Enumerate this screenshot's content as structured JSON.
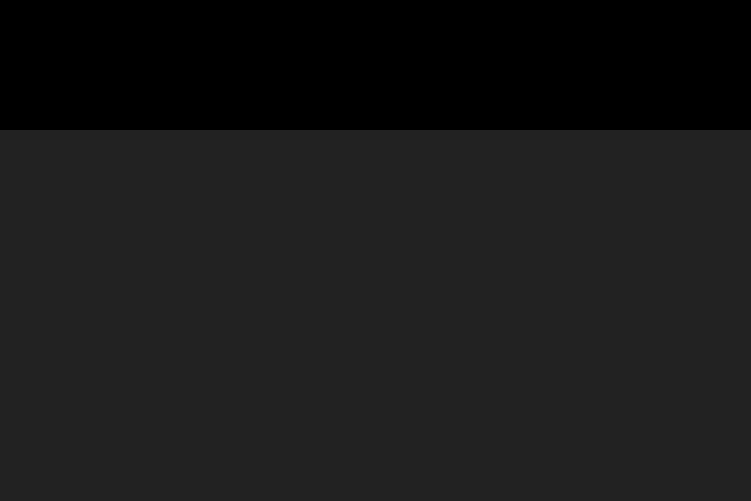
{
  "meta": {
    "type": "3d-architectural-aerial-rendering",
    "width_px": 751,
    "height_px": 501
  },
  "scene": {
    "description": "Aerial 3D rendering of a master-planned desert community: rows of flat-roofed beige villas along a tree-lined street grid, a long retail strip with a gray roof, dark colonnade, palm trees and orange patio umbrellas, a red-brown parking lot with parked cars, a wide arterial road with double yellow dashed lane lines and crosswalks, windbreak poplar rows, farm fields, and hazy mountains with a snow-capped peak under a pale blue sky.",
    "elements": [
      "sky",
      "mountain-range",
      "snow-capped-peak",
      "farm-fields",
      "windbreak-poplar-rows",
      "open-pasture",
      "residential-villas",
      "neighborhood-streets",
      "left-boulevard",
      "retail-strip-building",
      "entry-tower",
      "patio-umbrellas",
      "palm-trees",
      "monument-sign",
      "red-retail-signs",
      "parking-lot",
      "parking-stripes",
      "parked-cars",
      "access-apron",
      "landscaped-median",
      "roundabout",
      "arterial-road",
      "yellow-lane-dashes",
      "crosswalks",
      "moving-cars",
      "sidewalk",
      "foreground-lawn",
      "foreground-poplar-trees",
      "tree-shadows"
    ],
    "counts": {
      "patio_umbrellas": 6,
      "foreground_poplars": 11,
      "windbreak_rows": 2,
      "palm_trees": 18,
      "parked_cars_main_lot": 27,
      "parked_cars_upper_row": 6,
      "moving_cars": 7,
      "crosswalks": 3,
      "residential_house_rows": 7
    }
  },
  "palette": {
    "sky_top": "#c7d9e1",
    "sky_horizon": "#e9efee",
    "mountain_far": "#c9c2b0",
    "mountain_near": "#a9a795",
    "snow": "#f6f6f1",
    "haze": "#ffffff",
    "farm_base": "#b5bf9c",
    "field_light": "#cdd3b4",
    "field_green": "#9db987",
    "field_tan": "#d6d1b6",
    "field_green2": "#92af7d",
    "field_brown": "#8f7250",
    "open_field": "#8fae6a",
    "fence": "#eeeee4",
    "poplar_dark": "#2f5226",
    "poplar_mid": "#3e6130",
    "poplar_light": "#5a7d36",
    "res_green": "#7e9455",
    "res_green2": "#88a05f",
    "verge_green": "#6f854b",
    "street_tan": "#b1ada0",
    "street_gray": "#7a7e81",
    "boulevard": "#7e8184",
    "sidewalk": "#cfccc4",
    "house_wall": "#dfd6bd",
    "house_wall2": "#d6cbae",
    "house_roof": "#e8e0ca",
    "house_shade": "#8d8471",
    "house_dark": "#4a4038",
    "tree_dark": "#35552a",
    "tree_mid": "#467031",
    "tree_light": "#578338",
    "strip_roof": "#c6c5bf",
    "strip_fascia": "#f0efe9",
    "strip_face": "#332e28",
    "strip_column": "#d8d0c0",
    "plaza": "#d6cfc0",
    "patio": "#ded7c8",
    "umbrella": "#d2662a",
    "umbrella_dark": "#a8481f",
    "palm": "#2c5024",
    "palm_trunk": "#6b5a42",
    "upper_roof": "#b5b0a6",
    "monument": "#8a3b2c",
    "sign_red": "#a03428",
    "parking": "#6b4c44",
    "parking_light": "#7a574d",
    "stripe": "#eceae3",
    "pole": "#3c3c3c",
    "road": "#8b8c88",
    "road_light": "#9a988f",
    "road_edge": "#e8e6df",
    "lane_yellow": "#c9a23e",
    "lane_white": "#d8d6cf",
    "car_white": "#f2f1ee",
    "car_dark": "#2e3134",
    "car_silver": "#c3c6c8",
    "car_glass": "#23262a",
    "lawn": "#76833f",
    "lawn2": "#8a9751",
    "lawn_streak": "#98a35c",
    "shadow": "#3f4f2a",
    "trunk": "#9b8a68",
    "planter_base": "#cfc8b2",
    "shrub": "#5d7a3a"
  },
  "layout": {
    "seed": 987654321,
    "mountain_far_ridge": [
      [
        0,
        86
      ],
      [
        30,
        78
      ],
      [
        70,
        72
      ],
      [
        100,
        78
      ],
      [
        130,
        86
      ],
      [
        160,
        82
      ],
      [
        200,
        90
      ],
      [
        240,
        86
      ],
      [
        280,
        94
      ],
      [
        320,
        90
      ],
      [
        360,
        95
      ],
      [
        395,
        88
      ],
      [
        430,
        80
      ],
      [
        465,
        72
      ],
      [
        495,
        66
      ],
      [
        520,
        58
      ],
      [
        540,
        50
      ],
      [
        552,
        56
      ],
      [
        565,
        64
      ],
      [
        585,
        60
      ],
      [
        605,
        55
      ],
      [
        625,
        64
      ],
      [
        645,
        60
      ],
      [
        665,
        68
      ],
      [
        685,
        62
      ],
      [
        705,
        72
      ],
      [
        725,
        66
      ],
      [
        751,
        72
      ]
    ],
    "mountain_near_ridge": [
      [
        370,
        112
      ],
      [
        400,
        96
      ],
      [
        430,
        88
      ],
      [
        455,
        92
      ],
      [
        480,
        84
      ],
      [
        505,
        88
      ],
      [
        525,
        76
      ],
      [
        545,
        84
      ],
      [
        565,
        78
      ],
      [
        590,
        84
      ],
      [
        610,
        76
      ],
      [
        635,
        86
      ],
      [
        655,
        80
      ],
      [
        680,
        90
      ],
      [
        700,
        84
      ],
      [
        725,
        94
      ],
      [
        751,
        86
      ]
    ],
    "snow_peak": [
      [
        528,
        62
      ],
      [
        540,
        50
      ],
      [
        552,
        58
      ],
      [
        545,
        66
      ],
      [
        534,
        68
      ]
    ],
    "snow_patches": [
      [
        470,
        72,
        14,
        3,
        0.5
      ],
      [
        620,
        60,
        18,
        3.5,
        0.5
      ],
      [
        700,
        70,
        16,
        3,
        0.45
      ],
      [
        160,
        84,
        20,
        3,
        0.25
      ]
    ],
    "field_strips": [
      {
        "y": 110,
        "h": 7,
        "c": "field_light"
      },
      {
        "y": 117,
        "h": 7,
        "c": "field_green"
      },
      {
        "y": 124,
        "h": 6,
        "c": "field_tan"
      },
      {
        "y": 130,
        "h": 7,
        "c": "field_green2"
      },
      {
        "y": 137,
        "h": 7,
        "c": "field_brown"
      },
      {
        "y": 144,
        "h": 7,
        "c": "field_green"
      },
      {
        "y": 151,
        "h": 6,
        "c": "field_tan"
      },
      {
        "y": 157,
        "h": 6,
        "c": "field_green2"
      },
      {
        "y": 163,
        "h": 7,
        "c": "field_light"
      }
    ],
    "open_field_poly": [
      [
        555,
        108
      ],
      [
        751,
        92
      ],
      [
        751,
        172
      ],
      [
        575,
        168
      ]
    ],
    "fence_ys": [
      112,
      124,
      136,
      150
    ],
    "distant_blob_count": 34,
    "poplar_far": {
      "x0": 4,
      "x1": 748,
      "gap": 13.5,
      "bottom": 131,
      "h": 19
    },
    "poplar_near": {
      "x0": 2,
      "x1": 748,
      "gap": 17,
      "bottom0": 140,
      "bslope": 0.05,
      "h0": 24,
      "hslope": 0.045
    },
    "res_zone": [
      [
        0,
        138
      ],
      [
        230,
        142
      ],
      [
        470,
        152
      ],
      [
        751,
        166
      ],
      [
        751,
        240
      ],
      [
        0,
        420
      ]
    ],
    "res_streets": [
      {
        "x0": 80,
        "y0": 172,
        "slope": -0.055,
        "len": 620,
        "w": 5
      },
      {
        "x0": 0,
        "y0": 196,
        "slope": -0.062,
        "len": 720,
        "w": 6
      },
      {
        "x0": 0,
        "y0": 222,
        "slope": -0.075,
        "len": 720,
        "w": 7
      },
      {
        "x0": 0,
        "y0": 250,
        "slope": -0.085,
        "len": 660,
        "w": 7
      },
      {
        "x0": 0,
        "y0": 280,
        "slope": -0.095,
        "len": 480,
        "w": 8
      },
      {
        "x0": 0,
        "y0": 312,
        "slope": -0.105,
        "len": 300,
        "w": 8
      }
    ],
    "cross_streets": [
      {
        "x0": 208,
        "y0": 150,
        "len": 150
      },
      {
        "x0": 300,
        "y0": 148,
        "len": 150
      },
      {
        "x0": 392,
        "y0": 148,
        "len": 130
      },
      {
        "x0": 480,
        "y0": 150,
        "len": 115
      },
      {
        "x0": 565,
        "y0": 154,
        "len": 90
      }
    ],
    "house_rows": [
      {
        "x0": 150,
        "y0": 160,
        "slope": -0.05,
        "len": 470,
        "w": 11,
        "h": 6,
        "gap": 23
      },
      {
        "x0": 60,
        "y0": 183,
        "slope": -0.06,
        "len": 680,
        "w": 13,
        "h": 7,
        "gap": 25
      },
      {
        "x0": 0,
        "y0": 209,
        "slope": -0.068,
        "len": 745,
        "w": 15,
        "h": 8,
        "gap": 27
      },
      {
        "x0": 0,
        "y0": 236,
        "slope": -0.078,
        "len": 730,
        "w": 17,
        "h": 9,
        "gap": 30
      },
      {
        "x0": 0,
        "y0": 264,
        "slope": -0.088,
        "len": 560,
        "w": 19,
        "h": 11,
        "gap": 33
      },
      {
        "x0": 0,
        "y0": 294,
        "slope": -0.1,
        "len": 390,
        "w": 22,
        "h": 12,
        "gap": 37
      },
      {
        "x0": 30,
        "y0": 322,
        "slope": -0.11,
        "len": 180,
        "w": 24,
        "h": 14,
        "gap": 42
      }
    ],
    "res_tree_count": 62,
    "boulevard": {
      "poly": [
        [
          30,
          150
        ],
        [
          52,
          150
        ],
        [
          98,
          448
        ],
        [
          74,
          452
        ]
      ]
    },
    "left_verge": [
      [
        0,
        150
      ],
      [
        30,
        150
      ],
      [
        74,
        452
      ],
      [
        0,
        470
      ]
    ],
    "diag_streets": [
      {
        "y0": 210,
        "len": 280
      },
      {
        "y0": 254,
        "len": 270
      },
      {
        "y0": 298,
        "len": 250
      },
      {
        "y0": 344,
        "len": 200
      },
      {
        "y0": 390,
        "len": 120
      }
    ],
    "strip": {
      "roofA": [
        162,
        290
      ],
      "roofB": [
        751,
        198
      ],
      "depth": 22,
      "colonnade": 13,
      "plaza": 9
    },
    "anchor_box": [
      [
        196,
        248
      ],
      [
        300,
        232
      ],
      [
        306,
        252
      ],
      [
        202,
        268
      ]
    ],
    "tower": {
      "x": 194,
      "y": 256,
      "w": 14,
      "h": 36
    },
    "upper_retail": [
      [
        560,
        212
      ],
      [
        751,
        182
      ],
      [
        751,
        192
      ],
      [
        563,
        222
      ]
    ],
    "patio_poly": [
      [
        148,
        298
      ],
      [
        238,
        282
      ],
      [
        248,
        318
      ],
      [
        158,
        334
      ]
    ],
    "umbrellas": [
      {
        "x": 172,
        "y": 303
      },
      {
        "x": 184,
        "y": 306
      },
      {
        "x": 194,
        "y": 302
      },
      {
        "x": 200,
        "y": 314
      },
      {
        "x": 188,
        "y": 317
      },
      {
        "x": 209,
        "y": 310
      }
    ],
    "palm_line": {
      "a": [
        180,
        320
      ],
      "b": [
        740,
        232
      ],
      "gap": 32
    },
    "monument": {
      "x": 676,
      "y": 214,
      "w": 7,
      "h": 22
    },
    "red_signs": [
      [
        737,
        201,
        12,
        6
      ],
      [
        738,
        209,
        12,
        5
      ]
    ],
    "parking_poly": [
      [
        172,
        334
      ],
      [
        751,
        242
      ],
      [
        751,
        248
      ],
      [
        172,
        367
      ]
    ],
    "park_rowA": {
      "a": [
        312,
        316
      ],
      "b": [
        746,
        250
      ],
      "n": 50,
      "car_idx": [
        3,
        4,
        7,
        11,
        14,
        15,
        19,
        24,
        28,
        33,
        39,
        45,
        48
      ]
    },
    "park_rowB": {
      "a": [
        330,
        342
      ],
      "b": [
        751,
        278
      ],
      "n": 48,
      "car_idx": [
        2,
        5,
        6,
        9,
        13,
        17,
        18,
        23,
        29,
        34,
        40,
        44,
        46
      ]
    },
    "upper_cars": {
      "a": [
        598,
        206
      ],
      "b": [
        740,
        184
      ],
      "n": 6
    },
    "car_colors": [
      "car_white",
      "car_dark",
      "car_silver",
      "car_white",
      "car_silver",
      "car_dark",
      "car_white",
      "car_dark",
      "car_white",
      "car_silver",
      "car_dark",
      "car_white",
      "car_silver"
    ],
    "apron_poly": [
      [
        205,
        332
      ],
      [
        340,
        306
      ],
      [
        470,
        340
      ],
      [
        415,
        378
      ],
      [
        235,
        356
      ]
    ],
    "planter": {
      "cx": 255,
      "cy": 362,
      "rx": 66,
      "ry": 17,
      "rot": -12,
      "shrubs": 14
    },
    "roundabout": {
      "cx": 636,
      "cy": 244,
      "rx": 30,
      "ry": 10
    },
    "road_poly": [
      [
        0,
        402
      ],
      [
        751,
        248
      ],
      [
        751,
        312
      ],
      [
        0,
        494
      ]
    ],
    "road_edge_line": [
      [
        0,
        405
      ],
      [
        751,
        251
      ]
    ],
    "yellow1": [
      [
        0,
        444
      ],
      [
        751,
        276
      ]
    ],
    "yellow2": [
      [
        0,
        449
      ],
      [
        751,
        281
      ]
    ],
    "white_lane1": [
      [
        0,
        470
      ],
      [
        751,
        296
      ]
    ],
    "white_lane2": [
      [
        0,
        424
      ],
      [
        751,
        258
      ]
    ],
    "crosswalks": [
      {
        "x": 26,
        "y": 380,
        "rot": -4,
        "n": 8,
        "dx": 8,
        "bw": 3.5,
        "bh": 18
      },
      {
        "x": 416,
        "y": 341,
        "rot": -12,
        "n": 8,
        "dx": 8,
        "bw": 4,
        "bh": 20
      },
      {
        "x": 60,
        "y": 300,
        "rot": -10,
        "n": 5,
        "dx": 7,
        "bw": 3,
        "bh": 12
      }
    ],
    "road_cars": [
      {
        "x": 172,
        "y": 424,
        "rot": -11,
        "c": "car_white"
      },
      {
        "x": 352,
        "y": 359,
        "rot": -11,
        "c": "car_dark"
      },
      {
        "x": 672,
        "y": 262,
        "rot": -12,
        "c": "car_dark"
      },
      {
        "x": 660,
        "y": 272,
        "rot": -12,
        "c": "car_white"
      },
      {
        "x": 120,
        "y": 207,
        "rot": -14,
        "c": "car_dark"
      },
      {
        "x": 97,
        "y": 389,
        "rot": -10,
        "c": "car_white"
      },
      {
        "x": 36,
        "y": 167,
        "rot": -6,
        "c": "car_dark"
      }
    ],
    "sidewalk_poly": [
      [
        0,
        494
      ],
      [
        751,
        312
      ],
      [
        751,
        320
      ],
      [
        0,
        503
      ]
    ],
    "lawn_poly": [
      [
        0,
        503
      ],
      [
        751,
        320
      ],
      [
        751,
        501
      ],
      [
        0,
        501
      ]
    ],
    "lawn_streak_n": 9,
    "fg_trees": [
      {
        "x": 168,
        "top": 428,
        "bottom": 520
      },
      {
        "x": 262,
        "top": 452,
        "bottom": 530
      },
      {
        "x": 408,
        "top": 371,
        "bottom": 521
      },
      {
        "x": 472,
        "top": 347,
        "bottom": 473
      },
      {
        "x": 527,
        "top": 325,
        "bottom": 448
      },
      {
        "x": 578,
        "top": 312,
        "bottom": 433
      },
      {
        "x": 618,
        "top": 302,
        "bottom": 421
      },
      {
        "x": 655,
        "top": 292,
        "bottom": 413
      },
      {
        "x": 687,
        "top": 285,
        "bottom": 407
      },
      {
        "x": 718,
        "top": 287,
        "bottom": 401
      },
      {
        "x": 742,
        "top": 283,
        "bottom": 396
      }
    ]
  }
}
